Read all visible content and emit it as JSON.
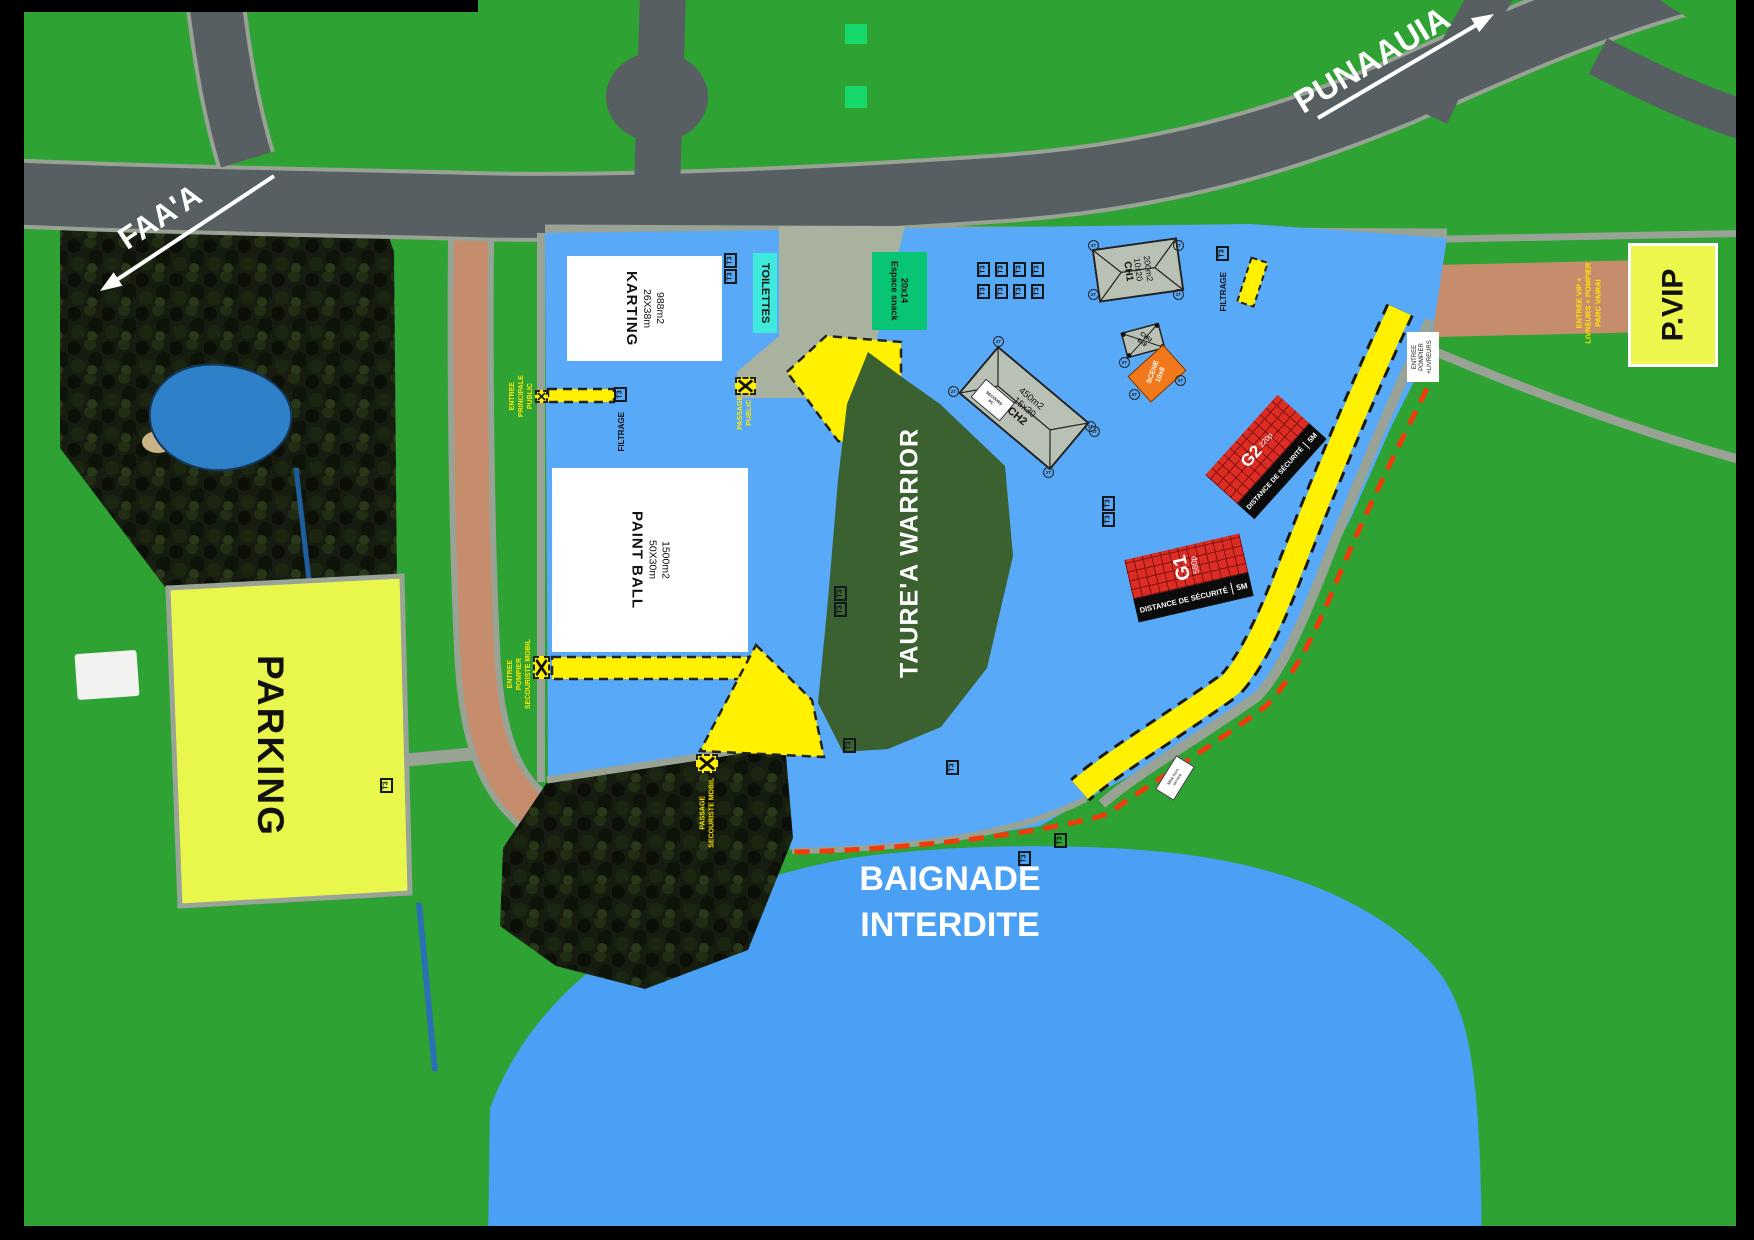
{
  "directions": {
    "west": "FAA'A",
    "east": "PUNAAUIA"
  },
  "areas": {
    "parking": "PARKING",
    "karting": {
      "name": "KARTING",
      "dims": "26X38m",
      "surface": "988m2"
    },
    "paintball": {
      "name": "PAINT BALL",
      "dims": "50X30m",
      "surface": "1500m2"
    },
    "toilets": "TOILETTES",
    "snack": {
      "name": "Espace snack",
      "dims": "20x14"
    },
    "pvip": "P.VIP",
    "taurea": "TAURE'A WARRIOR",
    "baignade": {
      "line1": "BAIGNADE",
      "line2": "INTERDITE"
    }
  },
  "structures": {
    "ch1": {
      "name": "CH1",
      "dims": "10x20",
      "surface": "200m2"
    },
    "ch2": {
      "name": "CH2",
      "dims": "15x30",
      "surface": "450m2",
      "sign_line1": "PC",
      "sign_line2": "SECOURS"
    },
    "chu": {
      "name": "CHU",
      "dims": "6x9"
    },
    "scene": {
      "name": "SCENE",
      "dims": "10x8"
    },
    "g1": {
      "name": "G1",
      "capacity": "580p",
      "safety": "DISTANCE DE SÉCURITÉ",
      "distance": "5M"
    },
    "g2": {
      "name": "G2",
      "capacity": "220p",
      "safety": "DISTANCE DE SÉCURITÉ",
      "distance": "5M"
    }
  },
  "access": {
    "main_entrance": [
      "ENTREE",
      "PRINCIPALE",
      "PUBLIC"
    ],
    "public_passage": [
      "PASSAGE",
      "PUBLIC"
    ],
    "fire_entrance_mobile": [
      "ENTREE",
      "POMPIER",
      "SECOURISTE MOBIL"
    ],
    "rescue_passage": [
      "PASSAGE",
      "SECOURISTE MOBIL"
    ],
    "vip_entrance": [
      "ENTREE VIP +",
      "LIVREURS + POMPIER",
      "PARC VAIRAI"
    ],
    "fire_delivery_entrance": [
      "ENTREE",
      "POMPIER",
      "+LIVREURS"
    ],
    "filtrage": "FILTRAGE"
  },
  "markers": {
    "t3": "T3",
    "t2": "2T",
    "t5": "5T",
    "t1": "1T"
  },
  "signs": {
    "mise_hors": [
      "Mise hors",
      "service"
    ]
  },
  "colors": {
    "field_green": "#2EA233",
    "zone_blue": "#58A9F8",
    "water_blue": "#49A0F5",
    "corridor_yellow": "#FFF100",
    "safety_red": "#F23B0B",
    "parking_yellow": "#E9F74D",
    "road_gray": "#575F62",
    "entrance_salmon": "#C68D6C"
  }
}
